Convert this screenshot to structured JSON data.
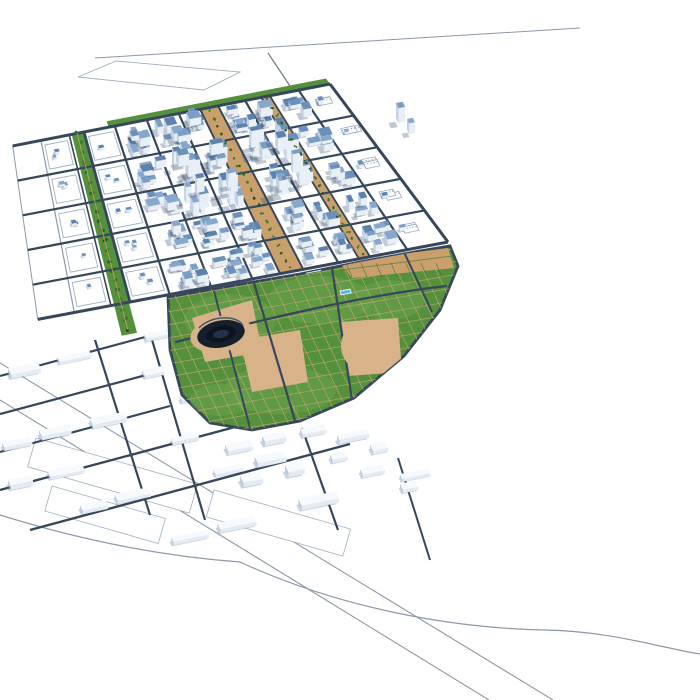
{
  "scene": {
    "type": "3d-city-masterplan-render",
    "landmarks": [
      "northwest-residential-grid",
      "left-green-boulevard",
      "central-tan-boulevards",
      "central-park",
      "stadium",
      "circus-dome",
      "exhibition-halls",
      "crescent-buildings",
      "park-pools",
      "east-white-district",
      "curved-boulevard",
      "southern-industrial-rows",
      "southeast-ring-park",
      "perimeter-roads"
    ]
  },
  "palette": {
    "background": "#ffffff",
    "road_dark": "#36475b",
    "road_outline": "#8d99a8",
    "parcel_line": "#9fb0c2",
    "blue_roof_1": "#6b90ba",
    "blue_roof_2": "#7b9ec6",
    "blue_roof_3": "#5d82ad",
    "blue_roof_4": "#87a8cc",
    "blue_wall": "#e9eff6",
    "blue_wall_dark": "#c2d2e3",
    "white_roof": "#f6fafd",
    "white_wall": "#e4ebf3",
    "white_wall_dark": "#b9cadf",
    "green_park": "#55913c",
    "green_light": "#69a24c",
    "green_dark": "#3b7a2e",
    "tree": "#2c6527",
    "tan": "#c9a06c",
    "tan_light": "#d8b288",
    "water": "#4ab5e6",
    "stadium_dark": "#161f2c",
    "circus_red": "#d2685c",
    "circus_red_dark": "#b94f44"
  }
}
